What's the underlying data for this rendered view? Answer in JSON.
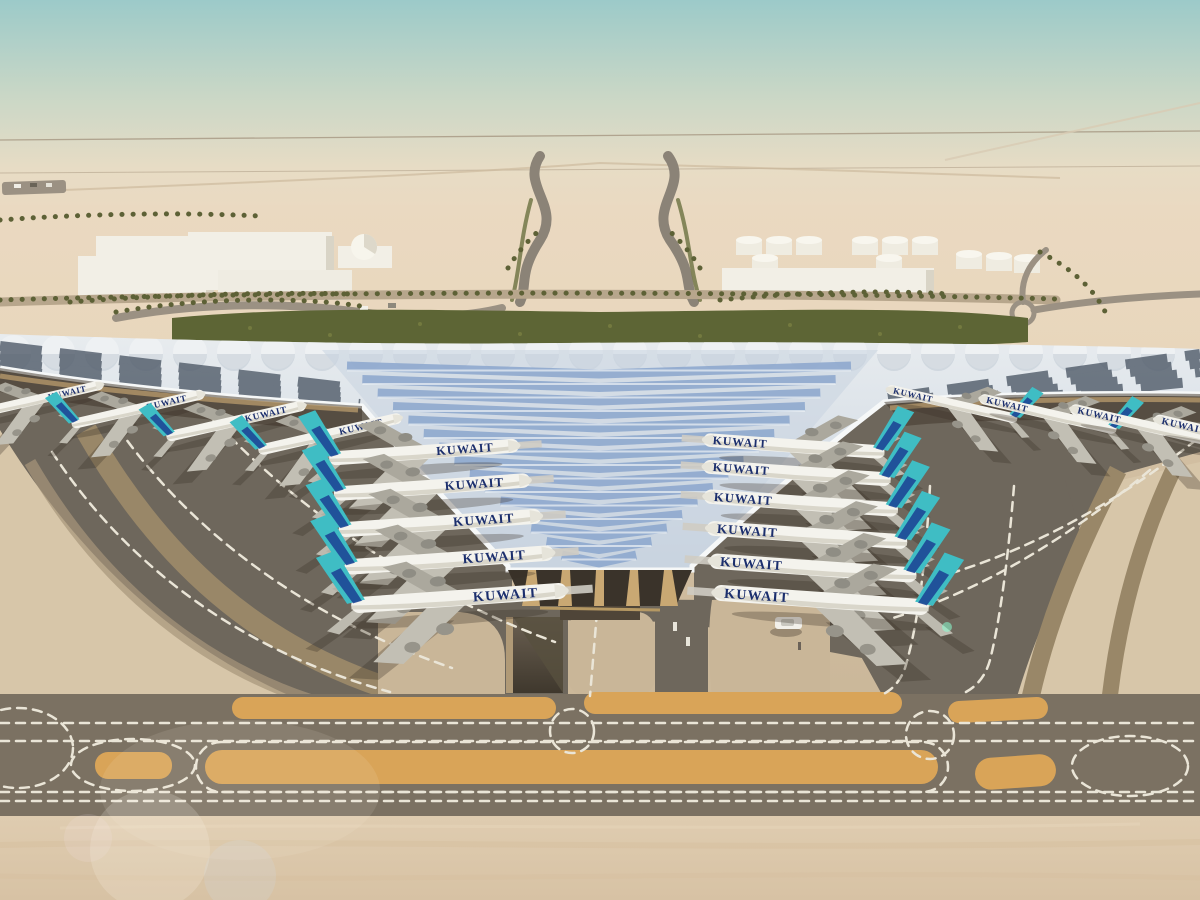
{
  "airline": {
    "title": "KUWAIT"
  },
  "colors": {
    "sky_top": "#9ccac9",
    "sky_mid": "#c9d7c6",
    "sky_haze": "#e7dcc5",
    "desert_far": "#ead9c1",
    "desert_mid": "#e4d0b0",
    "greenery": "#5d6535",
    "palm": "#5d6136",
    "roof_silver": "#e8ecef",
    "roof_shade": "#c9d4e0",
    "roof_blue": "#8ba6cc",
    "roof_rim": "#f6f8f8",
    "pv_dark": "#4f5a68",
    "facade_tan": "#c9a873",
    "apron_dark": "#6e675c",
    "apron_concrete": "#d3c0a3",
    "concrete_pale": "#d7c6a9",
    "band_asphalt": "#7b7162",
    "brown_band": "#998768",
    "sand_strip": "#d9a458",
    "dash": "#eae5d7",
    "tail_teal": "#3fbdc4",
    "tail_navy": "#1b3f93",
    "title_navy": "#1c2f6d",
    "fuselage": "#f4f3ed",
    "building_white": "#f2efe6",
    "foreground_concrete": "#dfccb0"
  },
  "planes": {
    "left_wing_row": [
      {
        "x": 40,
        "y": 399,
        "s": 0.6,
        "r": -13,
        "d": 1
      },
      {
        "x": 138,
        "y": 409,
        "s": 0.63,
        "r": -13,
        "d": 1
      },
      {
        "x": 236,
        "y": 421,
        "s": 0.66,
        "r": -13,
        "d": 1
      },
      {
        "x": 330,
        "y": 434,
        "s": 0.68,
        "r": -13,
        "d": 1
      }
    ],
    "right_wing_row": [
      {
        "x": 952,
        "y": 404,
        "s": 0.62,
        "r": 13,
        "d": -1
      },
      {
        "x": 1048,
        "y": 414,
        "s": 0.65,
        "r": 13,
        "d": -1
      },
      {
        "x": 1142,
        "y": 425,
        "s": 0.68,
        "r": 13,
        "d": -1
      },
      {
        "x": 1228,
        "y": 436,
        "s": 0.7,
        "r": 13,
        "d": -1
      }
    ],
    "left_column": [
      {
        "x": 424,
        "y": 452,
        "s": 0.88,
        "r": -4,
        "d": 1,
        "b": 1
      },
      {
        "x": 432,
        "y": 487,
        "s": 0.91,
        "r": -4,
        "d": 1,
        "b": 1
      },
      {
        "x": 440,
        "y": 523,
        "s": 0.94,
        "r": -4,
        "d": 1,
        "b": 1
      },
      {
        "x": 449,
        "y": 560,
        "s": 0.97,
        "r": -4,
        "d": 1,
        "b": 1
      },
      {
        "x": 459,
        "y": 598,
        "s": 1.0,
        "r": -4,
        "d": 1,
        "b": 1
      }
    ],
    "right_column": [
      {
        "x": 794,
        "y": 446,
        "s": 0.84,
        "r": 4,
        "d": -1,
        "b": 1
      },
      {
        "x": 797,
        "y": 473,
        "s": 0.87,
        "r": 4,
        "d": -1,
        "b": 1
      },
      {
        "x": 801,
        "y": 503,
        "s": 0.9,
        "r": 4,
        "d": -1,
        "b": 1
      },
      {
        "x": 807,
        "y": 535,
        "s": 0.93,
        "r": 4,
        "d": -1,
        "b": 1
      },
      {
        "x": 813,
        "y": 568,
        "s": 0.96,
        "r": 4,
        "d": -1,
        "b": 1
      },
      {
        "x": 821,
        "y": 600,
        "s": 1.0,
        "r": 4,
        "d": -1,
        "b": 1
      }
    ]
  }
}
